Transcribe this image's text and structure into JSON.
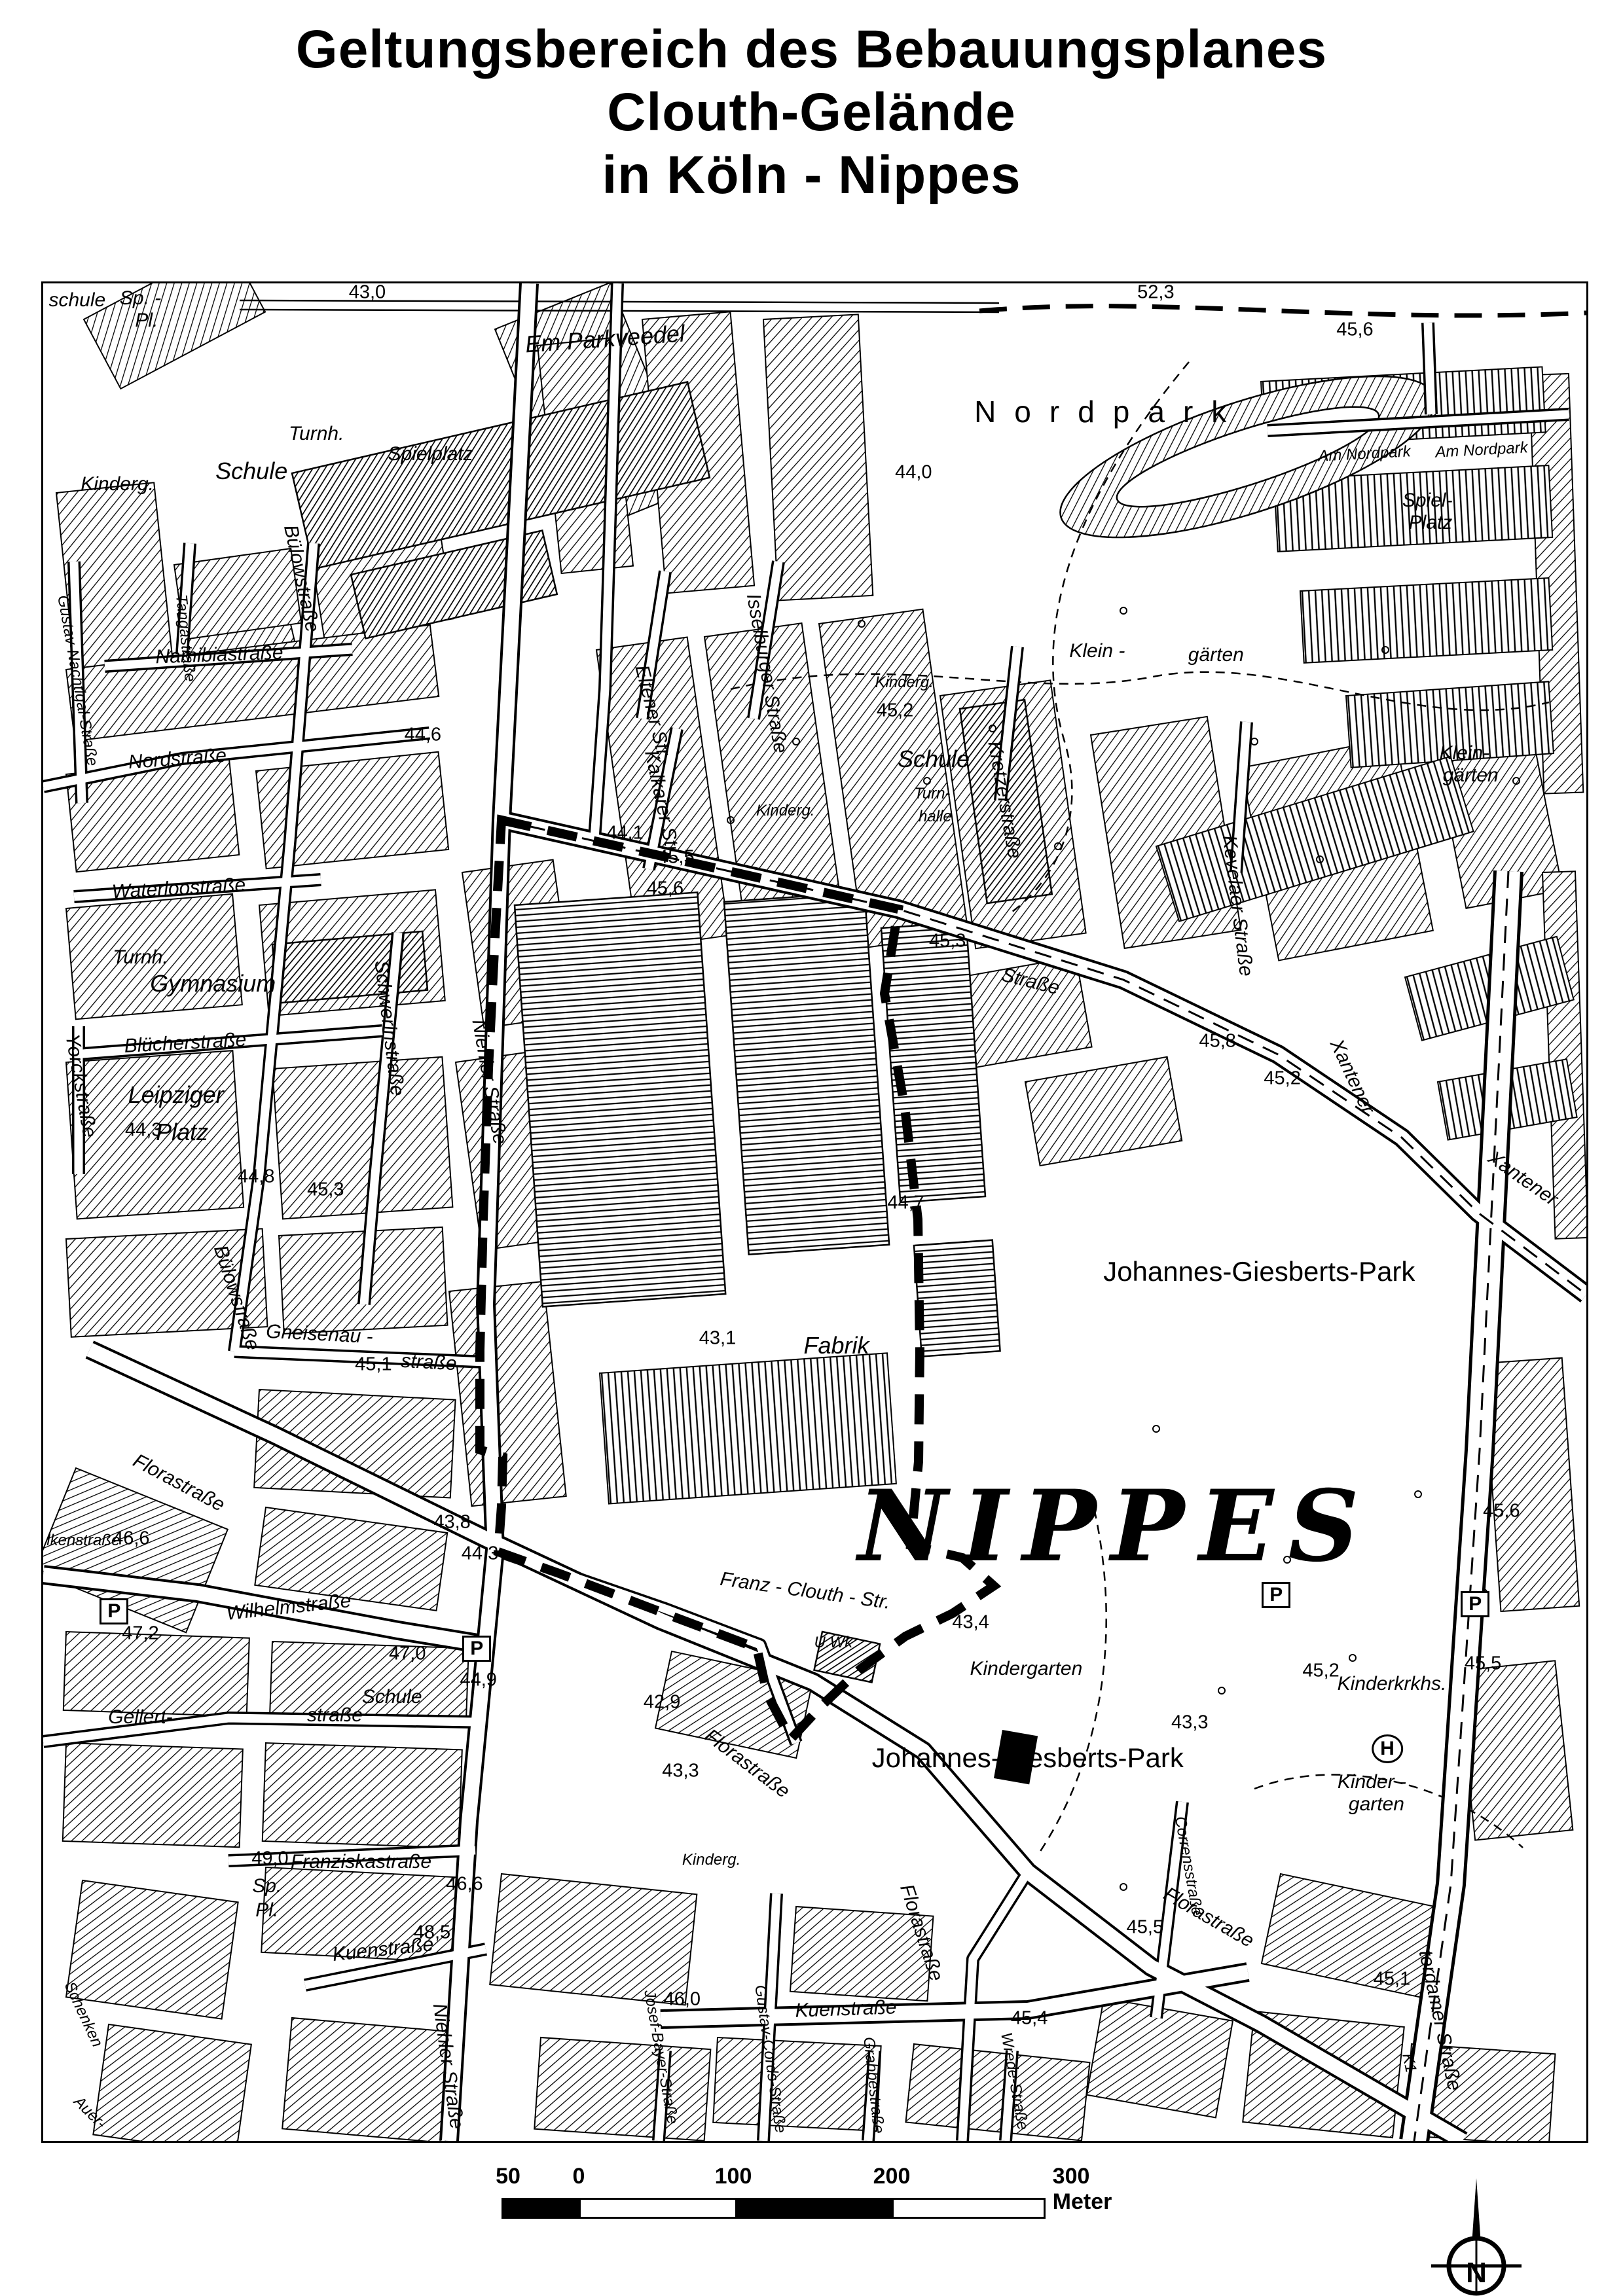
{
  "title": {
    "line1": "Geltungsbereich des Bebauungsplanes",
    "line2": "Clouth-Gelände",
    "line3": "in Köln - Nippes"
  },
  "scale": {
    "v50": "50",
    "v0": "0",
    "v100": "100",
    "v200": "200",
    "v300": "300 Meter"
  },
  "compass": {
    "letter": "N"
  },
  "map": {
    "labels": [
      {
        "t": "schule",
        "x": 2.2,
        "y": 0.9,
        "c": "pl"
      },
      {
        "t": "Sp. -",
        "x": 6.3,
        "y": 0.8,
        "c": "pl"
      },
      {
        "t": "Pl.",
        "x": 6.7,
        "y": 2.0,
        "c": "pl"
      },
      {
        "t": "43,0",
        "x": 21.0,
        "y": 0.5,
        "c": "el"
      },
      {
        "t": "Turnh.",
        "x": 17.7,
        "y": 8.1,
        "c": "pl"
      },
      {
        "t": "Schule",
        "x": 13.5,
        "y": 10.1,
        "c": "plB"
      },
      {
        "t": "Kinderg.",
        "x": 4.8,
        "y": 10.8,
        "c": "pl"
      },
      {
        "t": "Spielplatz",
        "x": 25.1,
        "y": 9.2,
        "c": "pl"
      },
      {
        "t": "Em Parkveedel",
        "x": 36.4,
        "y": 3.0,
        "r": -4,
        "c": "plB"
      },
      {
        "t": "Nordpark",
        "x": 69.1,
        "y": 6.9,
        "c": "nordpark"
      },
      {
        "t": "52,3",
        "x": 72.1,
        "y": 0.5,
        "c": "el"
      },
      {
        "t": "45,6",
        "x": 85.0,
        "y": 2.5,
        "c": "el"
      },
      {
        "t": "44,0",
        "x": 56.4,
        "y": 10.2,
        "c": "el"
      },
      {
        "t": "Am Nordpark",
        "x": 85.6,
        "y": 9.2,
        "r": -3,
        "c": "stS"
      },
      {
        "t": "Am Nordpark",
        "x": 93.2,
        "y": 9.0,
        "r": -3,
        "c": "stS"
      },
      {
        "t": "Spiel-",
        "x": 89.7,
        "y": 11.7,
        "c": "pl"
      },
      {
        "t": "Platz",
        "x": 89.9,
        "y": 12.9,
        "c": "pl"
      },
      {
        "t": "Klein -",
        "x": 68.3,
        "y": 19.8,
        "c": "pl"
      },
      {
        "t": "gärten",
        "x": 76.0,
        "y": 20.0,
        "c": "pl"
      },
      {
        "t": "Klein-",
        "x": 92.1,
        "y": 25.3,
        "c": "pl"
      },
      {
        "t": "gärten",
        "x": 92.5,
        "y": 26.5,
        "c": "pl"
      },
      {
        "t": "Gustav-Nachtigal-Straße",
        "x": 2.2,
        "y": 21.4,
        "r": 80,
        "c": "stS"
      },
      {
        "t": "Tangastraße",
        "x": 9.2,
        "y": 19.1,
        "r": 84,
        "c": "stS"
      },
      {
        "t": "Namibiastraße",
        "x": 11.4,
        "y": 20.0,
        "r": -2,
        "c": "st"
      },
      {
        "t": "Bülowstraße",
        "x": 16.7,
        "y": 15.9,
        "r": 78,
        "c": "st"
      },
      {
        "t": "Nordstraße",
        "x": 8.7,
        "y": 25.6,
        "r": -4,
        "c": "st"
      },
      {
        "t": "44,6",
        "x": 24.6,
        "y": 24.3,
        "c": "el"
      },
      {
        "t": "Waterloostraße",
        "x": 8.8,
        "y": 32.6,
        "r": -3,
        "c": "st"
      },
      {
        "t": "Bülowstraße",
        "x": 12.5,
        "y": 54.6,
        "r": 72,
        "c": "st"
      },
      {
        "t": "Gneisenau -",
        "x": 17.9,
        "y": 56.6,
        "r": 3,
        "c": "st"
      },
      {
        "t": "45,1",
        "x": 21.4,
        "y": 58.2,
        "c": "el"
      },
      {
        "t": "straße",
        "x": 25.0,
        "y": 58.1,
        "r": 3,
        "c": "st"
      },
      {
        "t": "44,8",
        "x": 13.8,
        "y": 48.1,
        "c": "el"
      },
      {
        "t": "45,3",
        "x": 18.3,
        "y": 48.8,
        "c": "el"
      },
      {
        "t": "Turnh.",
        "x": 6.3,
        "y": 36.3,
        "c": "pl"
      },
      {
        "t": "Gymnasium",
        "x": 11.0,
        "y": 37.7,
        "c": "plB"
      },
      {
        "t": "Blücherstraße",
        "x": 9.2,
        "y": 40.9,
        "r": -3,
        "c": "st"
      },
      {
        "t": "Yorckstraße",
        "x": 2.4,
        "y": 43.2,
        "r": 80,
        "c": "st"
      },
      {
        "t": "Leipziger",
        "x": 8.6,
        "y": 43.7,
        "c": "plB"
      },
      {
        "t": "44,3",
        "x": 6.5,
        "y": 45.6,
        "c": "el"
      },
      {
        "t": "Platz",
        "x": 9.0,
        "y": 45.7,
        "c": "plB"
      },
      {
        "t": "Schwerinstraße",
        "x": 22.4,
        "y": 40.1,
        "r": 83,
        "c": "st"
      },
      {
        "t": "Eltener Str.",
        "x": 39.5,
        "y": 23.1,
        "r": 76,
        "c": "st"
      },
      {
        "t": "Isselburger Straße",
        "x": 46.9,
        "y": 21.0,
        "r": 80,
        "c": "st"
      },
      {
        "t": "Kalkarer Str.",
        "x": 40.1,
        "y": 28.0,
        "r": 78,
        "c": "st"
      },
      {
        "t": "Kinderg.",
        "x": 48.1,
        "y": 28.4,
        "c": "stS"
      },
      {
        "t": "Kinderg.",
        "x": 55.8,
        "y": 21.5,
        "c": "stS"
      },
      {
        "t": "45,2",
        "x": 55.2,
        "y": 23.0,
        "c": "el"
      },
      {
        "t": "Schule",
        "x": 57.7,
        "y": 25.6,
        "c": "plB"
      },
      {
        "t": "Turn-",
        "x": 57.6,
        "y": 27.5,
        "c": "stS"
      },
      {
        "t": "halle",
        "x": 57.8,
        "y": 28.7,
        "c": "stS"
      },
      {
        "t": "Kretzerstraße",
        "x": 62.3,
        "y": 27.8,
        "r": 80,
        "c": "st"
      },
      {
        "t": "Kevelaer Straße",
        "x": 77.4,
        "y": 33.5,
        "r": 83,
        "c": "st"
      },
      {
        "t": "45,8",
        "x": 76.1,
        "y": 40.8,
        "c": "el"
      },
      {
        "t": "45,2",
        "x": 80.3,
        "y": 42.8,
        "c": "el"
      },
      {
        "t": "Xantener",
        "x": 84.8,
        "y": 42.7,
        "r": 65,
        "c": "st"
      },
      {
        "t": "Straße",
        "x": 64.0,
        "y": 37.6,
        "r": 14,
        "c": "st"
      },
      {
        "t": "Xantener",
        "x": 95.9,
        "y": 48.2,
        "r": 35,
        "c": "st"
      },
      {
        "t": "44,1",
        "x": 37.7,
        "y": 29.6,
        "c": "el"
      },
      {
        "t": "45,5",
        "x": 41.0,
        "y": 30.9,
        "c": "el"
      },
      {
        "t": "45,6",
        "x": 40.3,
        "y": 32.6,
        "c": "el"
      },
      {
        "t": "45,3",
        "x": 58.6,
        "y": 35.4,
        "c": "el"
      },
      {
        "t": "Niehler Straße",
        "x": 28.9,
        "y": 43.0,
        "r": 80,
        "c": "st"
      },
      {
        "t": "44,7",
        "x": 55.9,
        "y": 49.5,
        "c": "el"
      },
      {
        "t": "43,1",
        "x": 43.7,
        "y": 56.8,
        "c": "el"
      },
      {
        "t": "Fabrik",
        "x": 51.4,
        "y": 57.2,
        "c": "plB"
      },
      {
        "t": "Johannes-Giesberts-Park",
        "x": 78.8,
        "y": 53.2,
        "c": "pk"
      },
      {
        "t": "NIPPES",
        "x": 69.5,
        "y": 66.9,
        "c": "nippes",
        "n": "district-label-nippes"
      },
      {
        "t": "43,4",
        "x": 60.1,
        "y": 72.1,
        "c": "el"
      },
      {
        "t": "43,3",
        "x": 74.3,
        "y": 77.5,
        "c": "el"
      },
      {
        "t": "Franz - Clouth - Str.",
        "x": 49.4,
        "y": 70.4,
        "r": 8,
        "c": "st"
      },
      {
        "t": "U.Wk",
        "x": 51.2,
        "y": 73.2,
        "c": "stS"
      },
      {
        "t": "42,9",
        "x": 40.1,
        "y": 76.4,
        "c": "el"
      },
      {
        "t": "Florastraße",
        "x": 8.8,
        "y": 64.6,
        "r": 28,
        "c": "st"
      },
      {
        "t": "Florastraße",
        "x": 45.6,
        "y": 79.7,
        "r": 37,
        "c": "st"
      },
      {
        "t": "Florastraße",
        "x": 56.9,
        "y": 88.8,
        "r": 72,
        "c": "st"
      },
      {
        "t": "Florastraße",
        "x": 75.5,
        "y": 88.0,
        "r": 30,
        "c": "st"
      },
      {
        "t": "Kindergarten",
        "x": 63.7,
        "y": 74.6,
        "c": "pl"
      },
      {
        "t": "Johannes-Giesberts-Park",
        "x": 63.8,
        "y": 79.4,
        "c": "pk"
      },
      {
        "t": "43,3",
        "x": 41.3,
        "y": 80.1,
        "c": "el"
      },
      {
        "t": "Kinderg.",
        "x": 43.3,
        "y": 84.9,
        "c": "stS"
      },
      {
        "t": "Wilhelmstraße",
        "x": 15.9,
        "y": 71.3,
        "r": -6,
        "c": "st"
      },
      {
        "t": "47,2",
        "x": 6.3,
        "y": 72.7,
        "c": "el"
      },
      {
        "t": "47,0",
        "x": 23.6,
        "y": 73.8,
        "c": "el"
      },
      {
        "t": "44,9",
        "x": 28.2,
        "y": 75.2,
        "c": "el"
      },
      {
        "t": "Schule",
        "x": 22.6,
        "y": 76.1,
        "c": "pl"
      },
      {
        "t": "Gellert-",
        "x": 6.3,
        "y": 77.2,
        "c": "st"
      },
      {
        "t": "straße",
        "x": 18.9,
        "y": 77.1,
        "c": "st"
      },
      {
        "t": "49,0",
        "x": 14.7,
        "y": 84.8,
        "c": "el"
      },
      {
        "t": "Franziskastraße",
        "x": 20.6,
        "y": 85.0,
        "c": "st"
      },
      {
        "t": "Sp.",
        "x": 14.5,
        "y": 86.3,
        "c": "pl"
      },
      {
        "t": "Pl.",
        "x": 14.5,
        "y": 87.6,
        "c": "pl"
      },
      {
        "t": "46,6",
        "x": 27.3,
        "y": 86.2,
        "c": "el"
      },
      {
        "t": "lkenstraße",
        "x": 2.6,
        "y": 67.7,
        "c": "stS"
      },
      {
        "t": "46,6",
        "x": 5.7,
        "y": 67.6,
        "c": "el"
      },
      {
        "t": "43,8",
        "x": 26.5,
        "y": 66.7,
        "c": "el"
      },
      {
        "t": "44,3",
        "x": 28.3,
        "y": 68.4,
        "c": "el"
      },
      {
        "t": "48,5",
        "x": 25.2,
        "y": 88.8,
        "c": "el"
      },
      {
        "t": "Kuenstraße",
        "x": 22.0,
        "y": 89.7,
        "r": -6,
        "c": "st"
      },
      {
        "t": "Kuenstraße",
        "x": 52.0,
        "y": 92.9,
        "r": -2,
        "c": "st"
      },
      {
        "t": "46,0",
        "x": 41.4,
        "y": 92.4,
        "c": "el"
      },
      {
        "t": "45,4",
        "x": 63.9,
        "y": 93.4,
        "c": "el"
      },
      {
        "t": "Josef-Bayer-Straße",
        "x": 40.0,
        "y": 95.5,
        "r": 80,
        "c": "stS"
      },
      {
        "t": "Gustav-Cords-Straße",
        "x": 47.1,
        "y": 95.6,
        "r": 82,
        "c": "stS"
      },
      {
        "t": "Grabbestraße",
        "x": 53.8,
        "y": 97.0,
        "r": 84,
        "c": "stS"
      },
      {
        "t": "Wrede-Straße",
        "x": 62.9,
        "y": 96.8,
        "r": 80,
        "c": "stS"
      },
      {
        "t": "Niehler Straße",
        "x": 26.2,
        "y": 96.0,
        "r": 82,
        "c": "st"
      },
      {
        "t": "Schenken",
        "x": 2.6,
        "y": 93.2,
        "r": 65,
        "c": "stS"
      },
      {
        "t": "Auer-",
        "x": 3.0,
        "y": 98.5,
        "r": 45,
        "c": "stS"
      },
      {
        "t": "Corrensstraße",
        "x": 74.2,
        "y": 85.2,
        "r": 80,
        "c": "stS"
      },
      {
        "t": "Kinderkrkhs.",
        "x": 87.4,
        "y": 75.4,
        "c": "pl"
      },
      {
        "t": "45,2",
        "x": 82.8,
        "y": 74.7,
        "c": "el"
      },
      {
        "t": "45,5",
        "x": 93.3,
        "y": 74.3,
        "c": "el"
      },
      {
        "t": "45,5",
        "x": 71.4,
        "y": 88.5,
        "c": "el"
      },
      {
        "t": "Kinder -",
        "x": 86.1,
        "y": 80.7,
        "c": "pl"
      },
      {
        "t": "garten",
        "x": 86.4,
        "y": 81.9,
        "c": "pl"
      },
      {
        "t": "45,1",
        "x": 87.4,
        "y": 91.3,
        "c": "el"
      },
      {
        "t": "terdamer Straße",
        "x": 90.5,
        "y": 93.5,
        "r": 78,
        "c": "st"
      },
      {
        "t": "K1",
        "x": 88.5,
        "y": 95.8,
        "r": 78,
        "c": "stS"
      },
      {
        "t": "45,6",
        "x": 94.5,
        "y": 66.1,
        "c": "el"
      },
      {
        "t": "P",
        "x": 4.6,
        "y": 71.5,
        "c": "psym",
        "n": "parking-symbol"
      },
      {
        "t": "P",
        "x": 28.1,
        "y": 73.5,
        "c": "psym",
        "n": "parking-symbol"
      },
      {
        "t": "P",
        "x": 79.9,
        "y": 70.6,
        "c": "psym",
        "n": "parking-symbol"
      },
      {
        "t": "P",
        "x": 92.8,
        "y": 71.1,
        "c": "psym",
        "n": "parking-symbol"
      },
      {
        "t": "H",
        "x": 87.1,
        "y": 78.9,
        "c": "hsym",
        "n": "hospital-helipad-symbol"
      }
    ]
  }
}
